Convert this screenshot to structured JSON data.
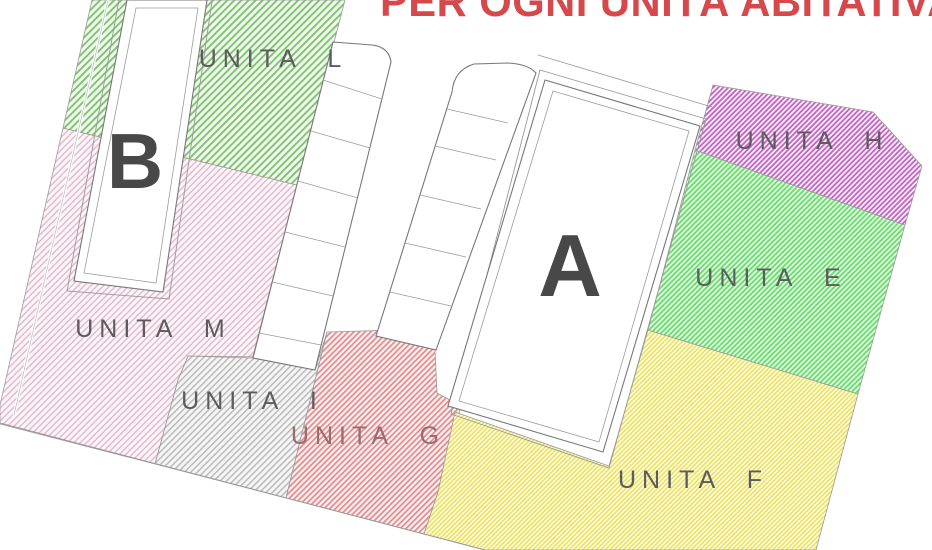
{
  "plan": {
    "title": "PER OGNI UNITÀ ABITATIVA",
    "title_color": "#d5494d",
    "buildings": {
      "a": "A",
      "b": "B"
    },
    "units": {
      "l": {
        "label": "UNITA L",
        "color": "#7fc470"
      },
      "m": {
        "label": "UNITA M",
        "color": "#e3bccd"
      },
      "i": {
        "label": "UNITA I",
        "color": "#bdbdbd"
      },
      "g": {
        "label": "UNITA G",
        "color": "#e28b8d"
      },
      "f": {
        "label": "UNITA F",
        "color": "#ece155"
      },
      "e": {
        "label": "UNITA E",
        "color": "#6ade6e"
      },
      "h": {
        "label": "UNITA H",
        "color": "#c365c3"
      }
    }
  }
}
